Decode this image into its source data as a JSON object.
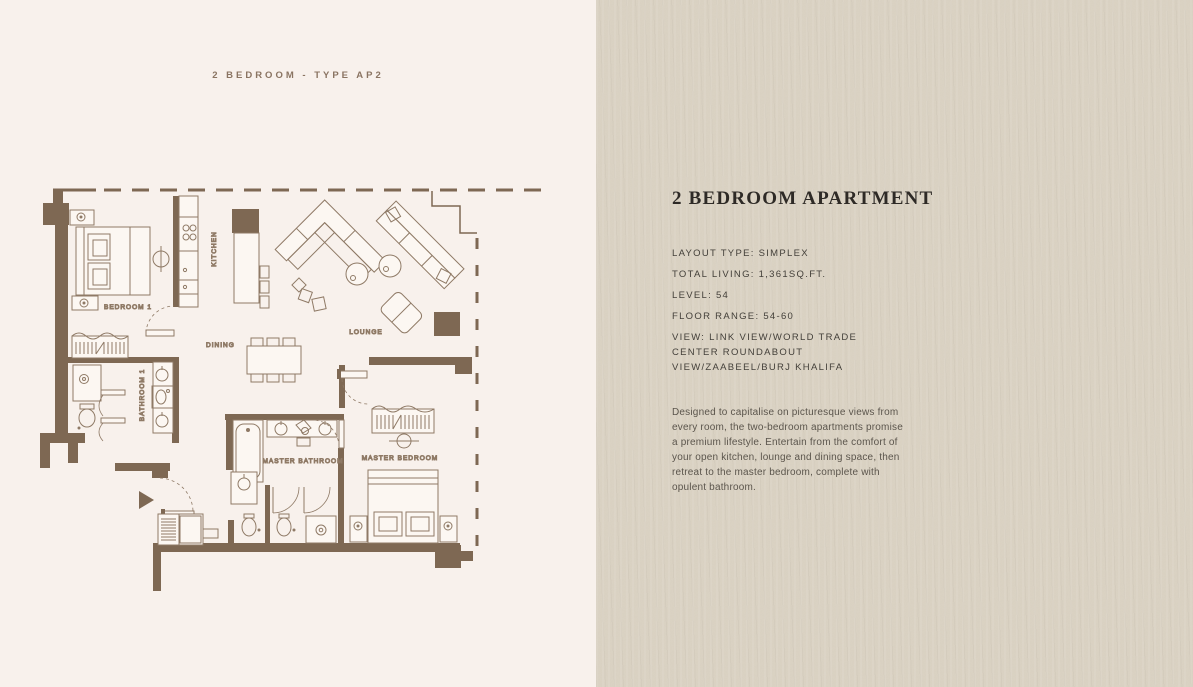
{
  "page": {
    "header_label": "2 BEDROOM - TYPE AP2"
  },
  "floor_plan": {
    "rooms": {
      "bedroom1": "BEDROOM 1",
      "kitchen": "KITCHEN",
      "dining": "DINING",
      "lounge": "LOUNGE",
      "bathroom1": "BATHROOM 1",
      "master_bathroom": "MASTER BATHROOM",
      "master_bedroom": "MASTER BEDROOM"
    }
  },
  "info_panel": {
    "title": "2 BEDROOM APARTMENT",
    "details": [
      "LAYOUT TYPE: SIMPLEX",
      "TOTAL LIVING: 1,361SQ.FT.",
      "LEVEL: 54",
      "FLOOR RANGE: 54-60",
      "VIEW: LINK VIEW/WORLD TRADE CENTER ROUNDABOUT VIEW/ZAABEEL/BURJ KHALIFA"
    ],
    "description": "Designed to capitalise on picturesque views from every room, the two-bedroom apartments promise a premium lifestyle. Entertain from the comfort of your open kitchen, lounge and dining space, then retreat to the master bedroom, complete with opulent bathroom."
  },
  "colors": {
    "wall_brown": "#7e6853",
    "plan_background": "#f8f1ec",
    "paper_background": "#dbd3c4",
    "title_ink": "#2e2a26",
    "body_ink": "#5b554c",
    "label_brown": "#8d7866"
  }
}
